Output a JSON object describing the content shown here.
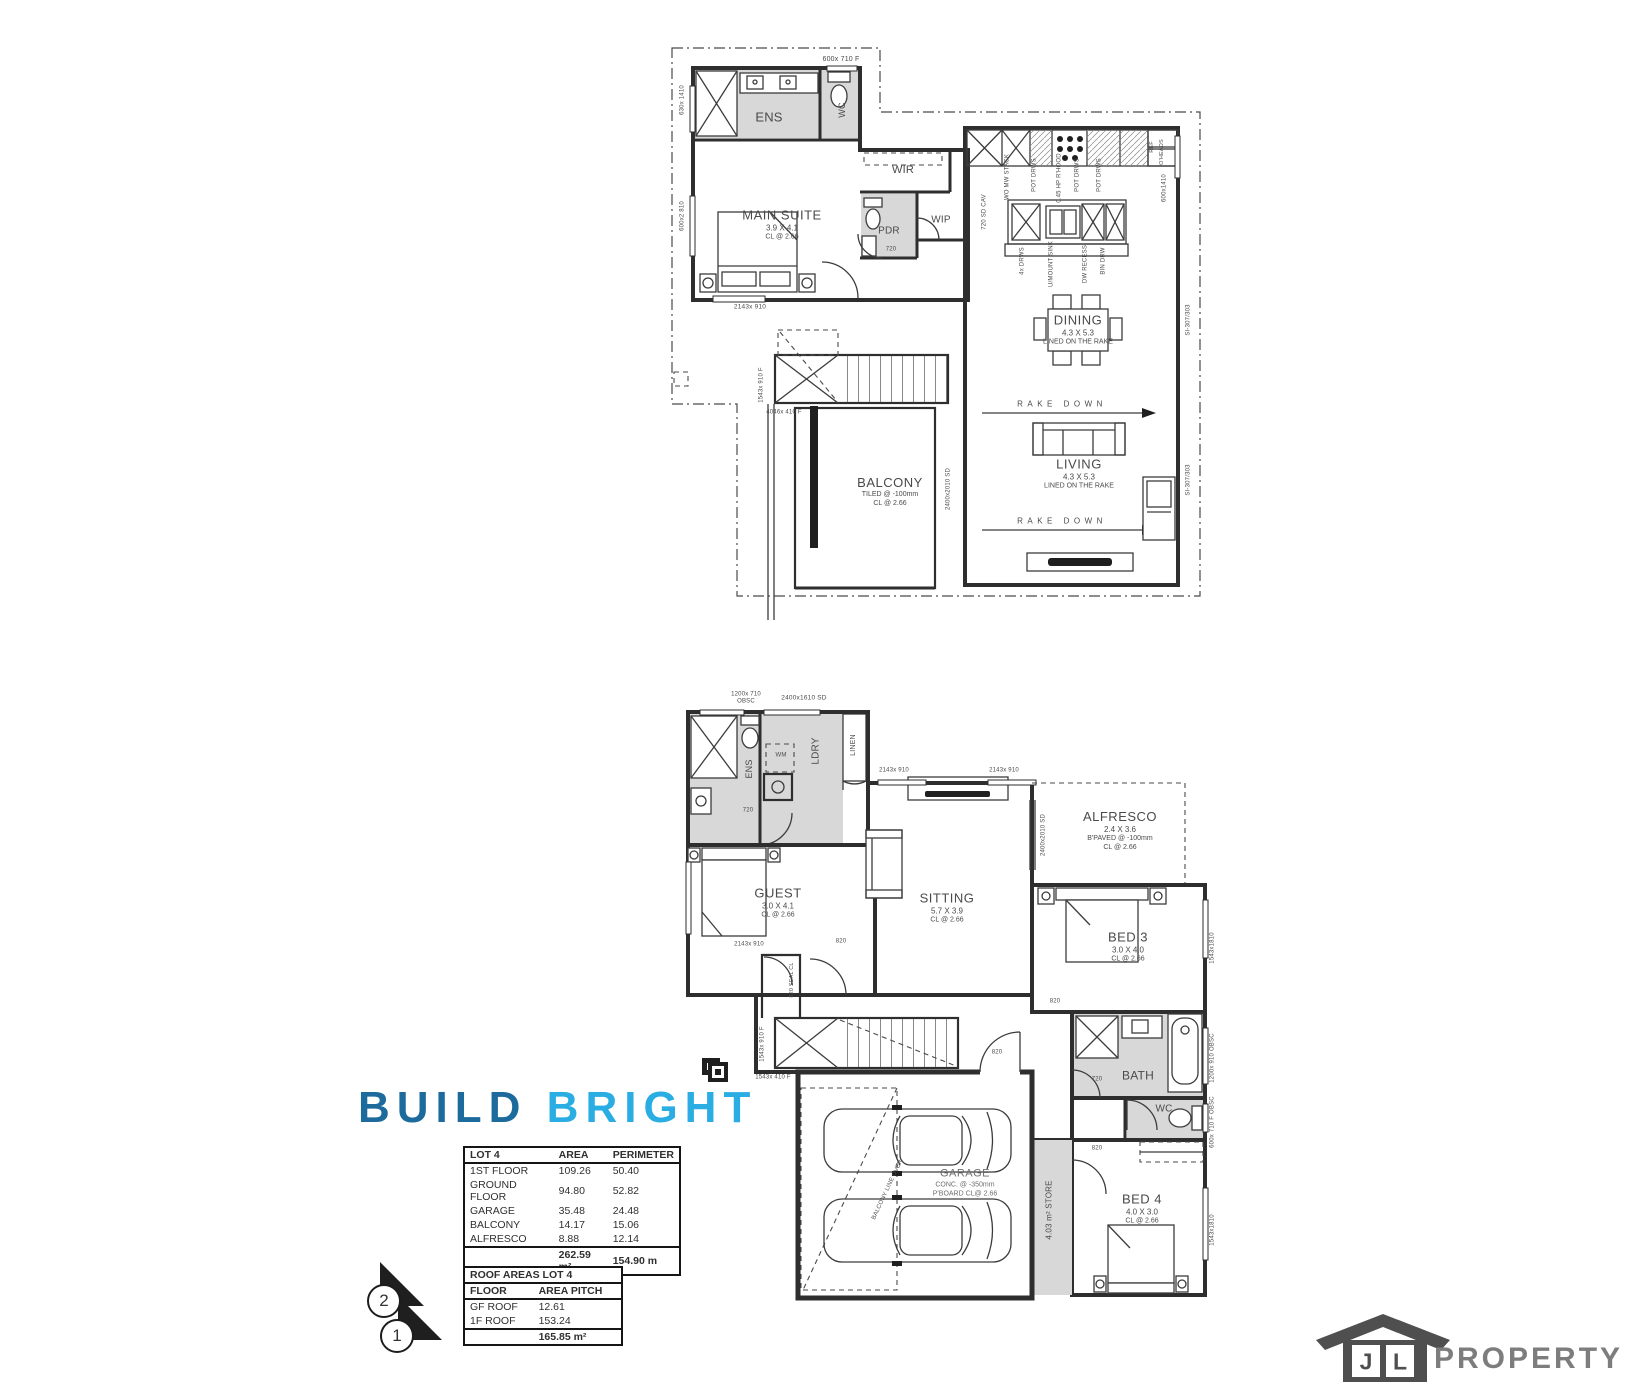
{
  "first_floor": {
    "rooms": {
      "ens": "ENS",
      "wc": "WC",
      "wir": "WIR",
      "pdr": "PDR",
      "wip": "WIP",
      "main_suite": {
        "name": "MAIN SUITE",
        "dims": "3.9 X 4.1",
        "ceiling": "CL @ 2.66"
      },
      "dining": {
        "name": "DINING",
        "dims": "4.3 X 5.3",
        "ceiling": "LINED ON THE RAKE"
      },
      "living": {
        "name": "LIVING",
        "dims": "4.3 X 5.3",
        "ceiling": "LINED ON THE RAKE"
      },
      "balcony": {
        "name": "BALCONY",
        "dims": "TILED @ -100mm",
        "ceiling": "CL @ 2.66"
      }
    },
    "kitchen": {
      "stack": "WO MW STACK",
      "pot1": "POT DRWS",
      "rangehood": "0.45 HP R'HOOD",
      "pot2": "POT DRWS",
      "pot3": "POT DRWS",
      "fridge": "REF",
      "overheads": "O'HEADS",
      "cavity_slider": "720 SD CAV",
      "drawers": "4x DRWS",
      "sink": "U/MOUNT SINK",
      "dishwasher": "DW RECESS",
      "bin": "BIN DRW"
    },
    "annotations": {
      "rake_down": "RAKE DOWN",
      "door_720": "720"
    },
    "windows": {
      "wc_top": "600x 710 F",
      "left_upper": "630x 1410",
      "left_lower": "600x2 810",
      "suite_sill": "2143x 910",
      "stair_side": "1543x 910 F",
      "stair_sill": "4046x 410 F",
      "kitchen_right": "600x1410",
      "living_right_1": "SI-307/303",
      "living_right_2": "SI-307/303",
      "balcony_slider": "2400x2010 SD"
    }
  },
  "ground_floor": {
    "rooms": {
      "ens": "ENS",
      "ldry": "LDRY",
      "linen": "LINEN",
      "bath": "BATH",
      "wc": "WC",
      "guest": {
        "name": "GUEST",
        "dims": "3.0 X 4.1",
        "ceiling": "CL @ 2.66"
      },
      "sitting": {
        "name": "SITTING",
        "dims": "5.7 X 3.9",
        "ceiling": "CL @ 2.66"
      },
      "alfresco": {
        "name": "ALFRESCO",
        "dims": "2.4 X 3.6",
        "paving": "B'PAVED @ -100mm",
        "ceiling": "CL @ 2.66"
      },
      "bed3": {
        "name": "BED 3",
        "dims": "3.0 X 4.0",
        "ceiling": "CL @ 2.66"
      },
      "bed4": {
        "name": "BED 4",
        "dims": "4.0 X 3.0",
        "ceiling": "CL @ 2.66"
      },
      "store": "4.03 m² STORE",
      "garage": {
        "name": "GARAGE",
        "floor": "CONC. @ -350mm",
        "ceiling": "P'BOARD CL@ 2.66"
      }
    },
    "annotations": {
      "wm": "WM",
      "balcony_over": "BALCONY LINE OVER",
      "stair_closet": "820 SEAL CL",
      "door_820": "820",
      "door_720": "720"
    },
    "windows": {
      "ens_top": "1200x 710\nOBSC",
      "ldry_slider": "2400x1610 SD",
      "sitting_1": "2143x 910",
      "sitting_2": "2143x 910",
      "guest_sill": "2143x 910",
      "alfresco_slider": "2400x2010 SD",
      "bed3_right": "1543x1810",
      "bath_right": "1200x 910 OBSC",
      "wc_right": "600x 710 F OBSC",
      "bed4_right": "1543x1810",
      "stair_side": "1543x 910 F",
      "stair_sill": "1543x 410 F"
    }
  },
  "area_table": {
    "title": "LOT 4",
    "col_area": "AREA",
    "col_perimeter": "PERIMETER",
    "rows": [
      {
        "name": "1ST FLOOR",
        "area": "109.26",
        "perimeter": "50.40"
      },
      {
        "name": "GROUND FLOOR",
        "area": "94.80",
        "perimeter": "52.82"
      },
      {
        "name": "GARAGE",
        "area": "35.48",
        "perimeter": "24.48"
      },
      {
        "name": "BALCONY",
        "area": "14.17",
        "perimeter": "15.06"
      },
      {
        "name": "ALFRESCO",
        "area": "8.88",
        "perimeter": "12.14"
      }
    ],
    "total_area": "262.59 m²",
    "total_perimeter": "154.90 m"
  },
  "roof_table": {
    "title": "ROOF AREAS LOT 4",
    "col_floor": "FLOOR",
    "col_area_pitch": "AREA PITCH",
    "rows": [
      {
        "name": "GF ROOF",
        "value": "12.61"
      },
      {
        "name": "1F ROOF",
        "value": "153.24"
      }
    ],
    "total": "165.85 m²"
  },
  "branding": {
    "build": "BUILD",
    "bright": "BRIGHT",
    "build_color": "#1d6a9d",
    "bright_color": "#29ade3",
    "jl_j": "J",
    "jl_l": "L",
    "property": "PROPERTY",
    "jl_color": "#4f4f4f",
    "property_color": "#7d7d7d"
  },
  "plan_markers": {
    "level_2": "2",
    "level_1": "1"
  }
}
